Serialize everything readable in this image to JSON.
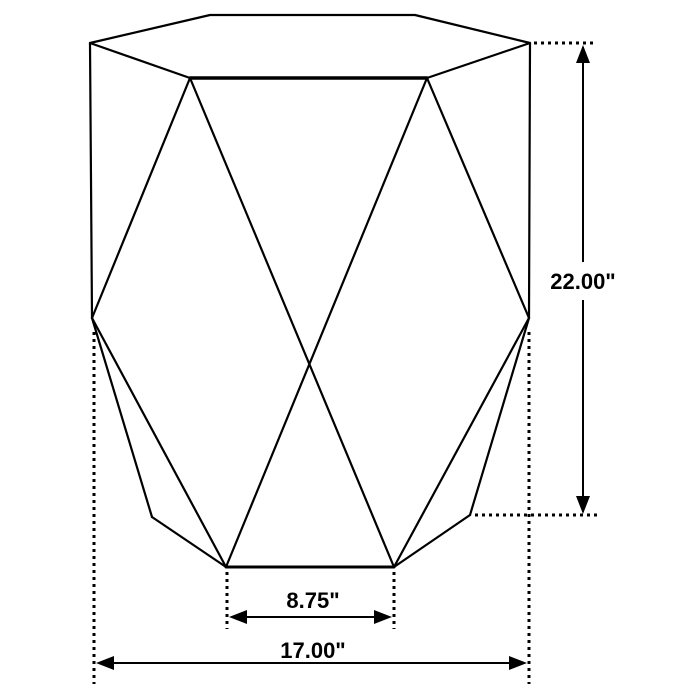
{
  "diagram": {
    "subject": "faceted hexagonal accent table line drawing with dimension callouts",
    "colors": {
      "line": "#000000",
      "background": "#ffffff",
      "text": "#000000"
    },
    "dims": {
      "height": {
        "label": "22.00\"",
        "value_in": 22.0,
        "orientation": "vertical"
      },
      "bottom_width": {
        "label": "8.75\"",
        "value_in": 8.75,
        "orientation": "horizontal"
      },
      "overall_width": {
        "label": "17.00\"",
        "value_in": 17.0,
        "orientation": "horizontal"
      }
    }
  }
}
